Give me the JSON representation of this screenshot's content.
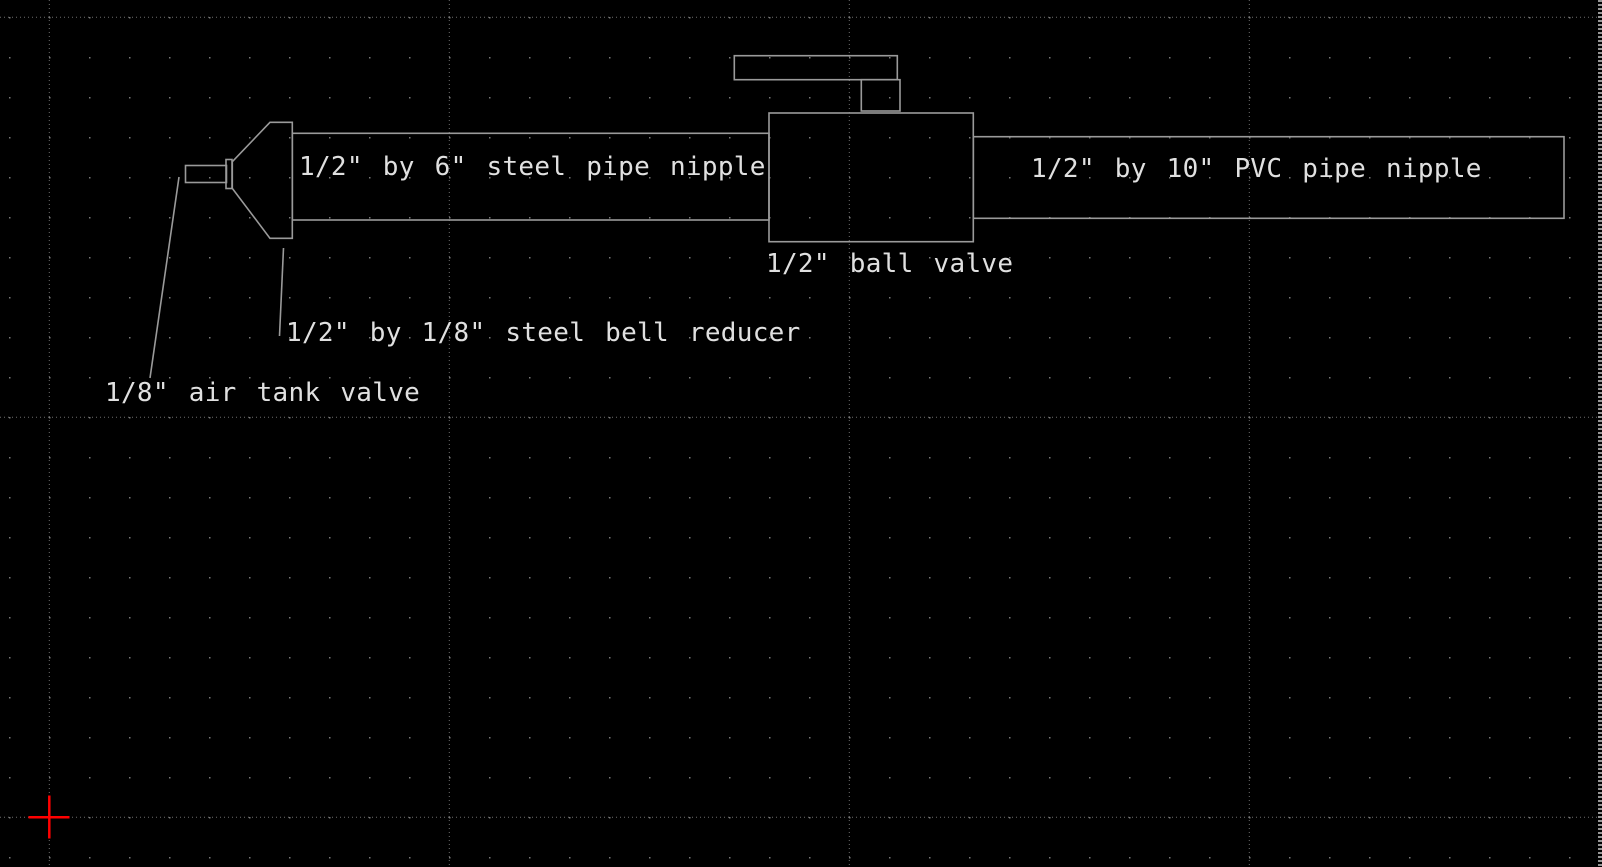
{
  "colors": {
    "bg": "#000000",
    "line": "#9a9a9a",
    "text": "#e0e0e0",
    "grid_dot": "#787878",
    "grid_major": "#6e6e6e",
    "origin": "#ff0000",
    "edge": "#959595"
  },
  "drawing": {
    "labels": {
      "steel_pipe": "1/2\" by 6\" steel pipe nipple",
      "pvc_pipe": "1/2\" by 10\" PVC pipe nipple",
      "ball_valve": "1/2\" ball valve",
      "bell_reducer": "1/2\" by 1/8\" steel bell reducer",
      "air_tank_valve": "1/8\" air tank valve"
    }
  }
}
